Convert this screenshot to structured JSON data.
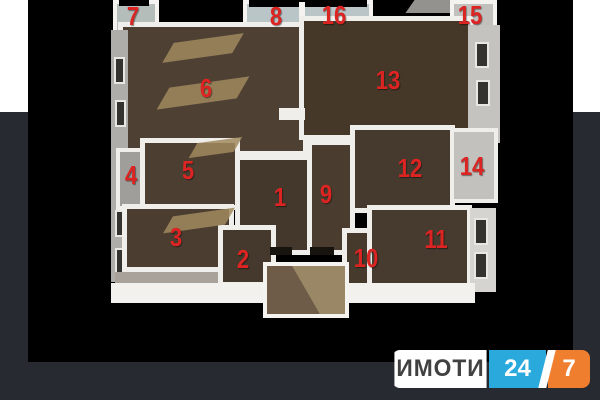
{
  "colors": {
    "page_bg": "#282a31",
    "photo_bg": "#000000",
    "top_band": "#ffffff",
    "wall_white": "#efeeea",
    "floor_brown": "#4a3d31",
    "number_red": "#dc2423",
    "logo_blue": "#29a9dc",
    "logo_orange": "#ef7e2e"
  },
  "plan": {
    "rooms": [
      {
        "label": "1"
      },
      {
        "label": "2"
      },
      {
        "label": "3"
      },
      {
        "label": "4"
      },
      {
        "label": "5"
      },
      {
        "label": "6"
      },
      {
        "label": "7"
      },
      {
        "label": "8"
      },
      {
        "label": "9"
      },
      {
        "label": "10"
      },
      {
        "label": "11"
      },
      {
        "label": "12"
      },
      {
        "label": "13"
      },
      {
        "label": "14"
      },
      {
        "label": "15"
      },
      {
        "label": "16"
      }
    ]
  },
  "logo": {
    "brand": "ИМОТИ",
    "number_24": "24",
    "number_7": "7"
  }
}
